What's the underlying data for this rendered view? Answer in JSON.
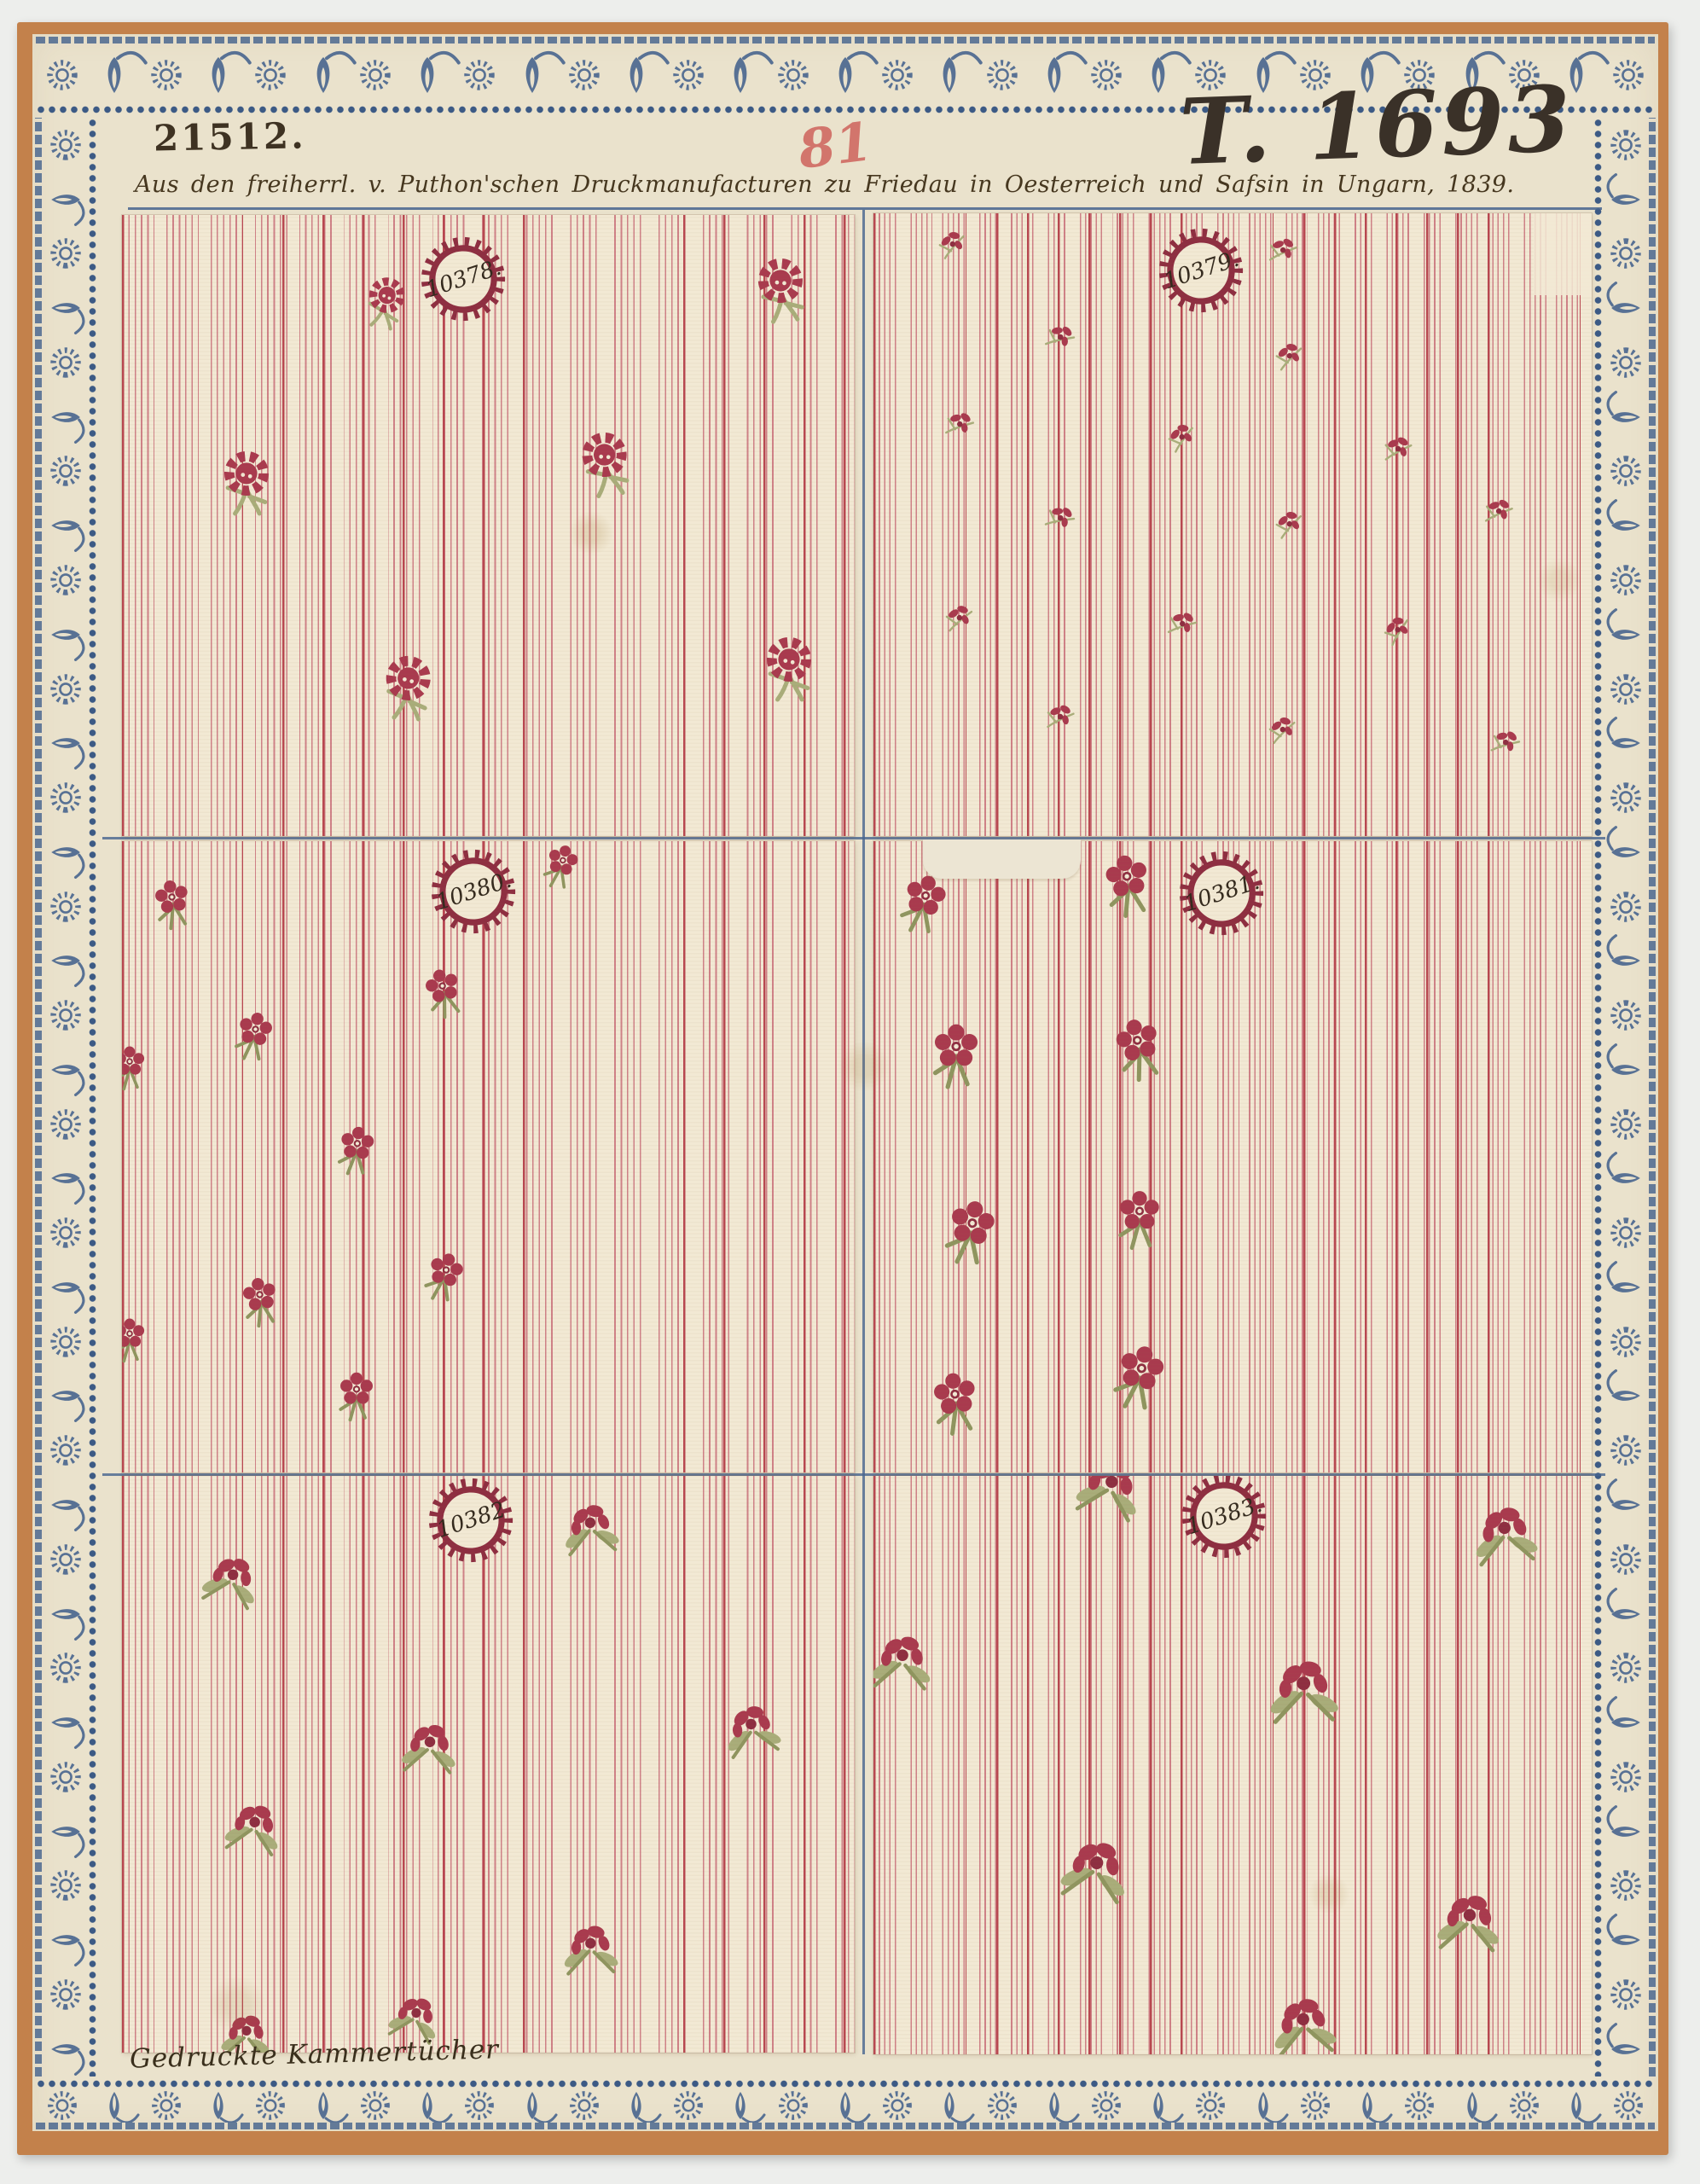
{
  "page": {
    "inventory_number": "21512.",
    "red_number": "81",
    "plate_number": "T. 1693",
    "caption": "Aus den freiherrl. v. Puthon'schen Druckmanufacturen zu Friedau in Oesterreich und Safsin in Ungarn, 1839.",
    "footer": "Gedruckte Kammertücher"
  },
  "colors": {
    "backdrop": "#edeeec",
    "board_orange": "#c3814b",
    "card_cream": "#eae2cc",
    "swatch_cream": "#f2e9d4",
    "stripe_red": "#b84750",
    "stripe_red_light": "#cf8187",
    "flower_crimson": "#a93a4e",
    "flower_dark": "#8e2e41",
    "leaf_green": "#a9ad7a",
    "stem_olive": "#8f955f",
    "border_blue": "#4c6890",
    "border_blue_dark": "#3c5a85",
    "rule_blue": "#46648e",
    "ink_brown": "#3e3222",
    "pencil_red": "#cd5a55"
  },
  "swatches": [
    {
      "number": "10378.",
      "label": {
        "x": 46.6,
        "y": 10.3
      },
      "sprig": "rose",
      "scale": 1,
      "sprigs": [
        [
          90,
          12,
          1,
          -6
        ],
        [
          36,
          14,
          0.8,
          12
        ],
        [
          17,
          43,
          1,
          0
        ],
        [
          66,
          40,
          1,
          -8
        ],
        [
          39,
          76,
          1,
          4
        ],
        [
          91,
          73,
          1,
          0
        ]
      ]
    },
    {
      "number": "10379.",
      "label": {
        "x": 45.6,
        "y": 9.2
      },
      "sprig": "tiny",
      "scale": 1,
      "sprigs": [
        [
          11,
          5,
          1,
          -15
        ],
        [
          57,
          6,
          1,
          10
        ],
        [
          26,
          20,
          1,
          22
        ],
        [
          58,
          23,
          1,
          -12
        ],
        [
          12,
          34,
          1,
          15
        ],
        [
          43,
          36,
          1,
          -20
        ],
        [
          73,
          38,
          1,
          6
        ],
        [
          26,
          49,
          1,
          24
        ],
        [
          58,
          50,
          1,
          -14
        ],
        [
          87,
          48,
          1,
          10
        ],
        [
          12,
          65,
          1,
          -6
        ],
        [
          43,
          66,
          1,
          16
        ],
        [
          73,
          67,
          1,
          -24
        ],
        [
          26,
          81,
          1,
          8
        ],
        [
          57,
          83,
          1,
          -10
        ],
        [
          88,
          85,
          1,
          18
        ]
      ]
    },
    {
      "number": "10380.",
      "label": {
        "x": 48,
        "y": 8
      },
      "sprig": "posy",
      "scale": 1,
      "sprigs": [
        [
          7,
          10,
          1,
          -10
        ],
        [
          60,
          4,
          0.9,
          14
        ],
        [
          1,
          36,
          0.9,
          0
        ],
        [
          18,
          31,
          1,
          10
        ],
        [
          44,
          24,
          1,
          -16
        ],
        [
          32,
          49,
          1,
          6
        ],
        [
          1,
          79,
          0.9,
          0
        ],
        [
          19,
          73,
          1,
          -10
        ],
        [
          44,
          69,
          1,
          14
        ],
        [
          32,
          88,
          1,
          0
        ]
      ]
    },
    {
      "number": "10381.",
      "label": {
        "x": 48.5,
        "y": 8.2
      },
      "sprig": "posy",
      "scale": 1.2,
      "sprigs": [
        [
          7,
          10,
          1,
          12
        ],
        [
          35.5,
          7,
          1.05,
          -10
        ],
        [
          11.5,
          34,
          1.1,
          0
        ],
        [
          37,
          33,
          1.05,
          -14
        ],
        [
          13.5,
          62,
          1.1,
          10
        ],
        [
          37,
          60,
          1,
          0
        ],
        [
          11.5,
          89,
          1.05,
          -8
        ],
        [
          37,
          85,
          1.1,
          12
        ]
      ]
    },
    {
      "number": "10382",
      "label": {
        "x": 47.6,
        "y": 7.7
      },
      "sprig": "leafrose",
      "scale": 1,
      "sprigs": [
        [
          64,
          9,
          1,
          -10
        ],
        [
          15,
          18,
          1,
          10
        ],
        [
          42,
          47,
          1,
          0
        ],
        [
          86,
          44,
          1,
          -14
        ],
        [
          18,
          61,
          1,
          6
        ],
        [
          64,
          82,
          1,
          -6
        ],
        [
          17,
          97,
          0.9,
          0
        ],
        [
          40,
          94,
          0.9,
          10
        ]
      ]
    },
    {
      "number": "10383.",
      "label": {
        "x": 48.8,
        "y": 6.9
      },
      "sprig": "leafrose",
      "scale": 1.15,
      "sprigs": [
        [
          33,
          2,
          1,
          10
        ],
        [
          88,
          10,
          1,
          -10
        ],
        [
          4,
          32,
          0.95,
          0
        ],
        [
          60,
          37,
          1.1,
          -6
        ],
        [
          31,
          68,
          1.05,
          6
        ],
        [
          83,
          77,
          1,
          0
        ],
        [
          60,
          95,
          1,
          -10
        ]
      ]
    }
  ]
}
